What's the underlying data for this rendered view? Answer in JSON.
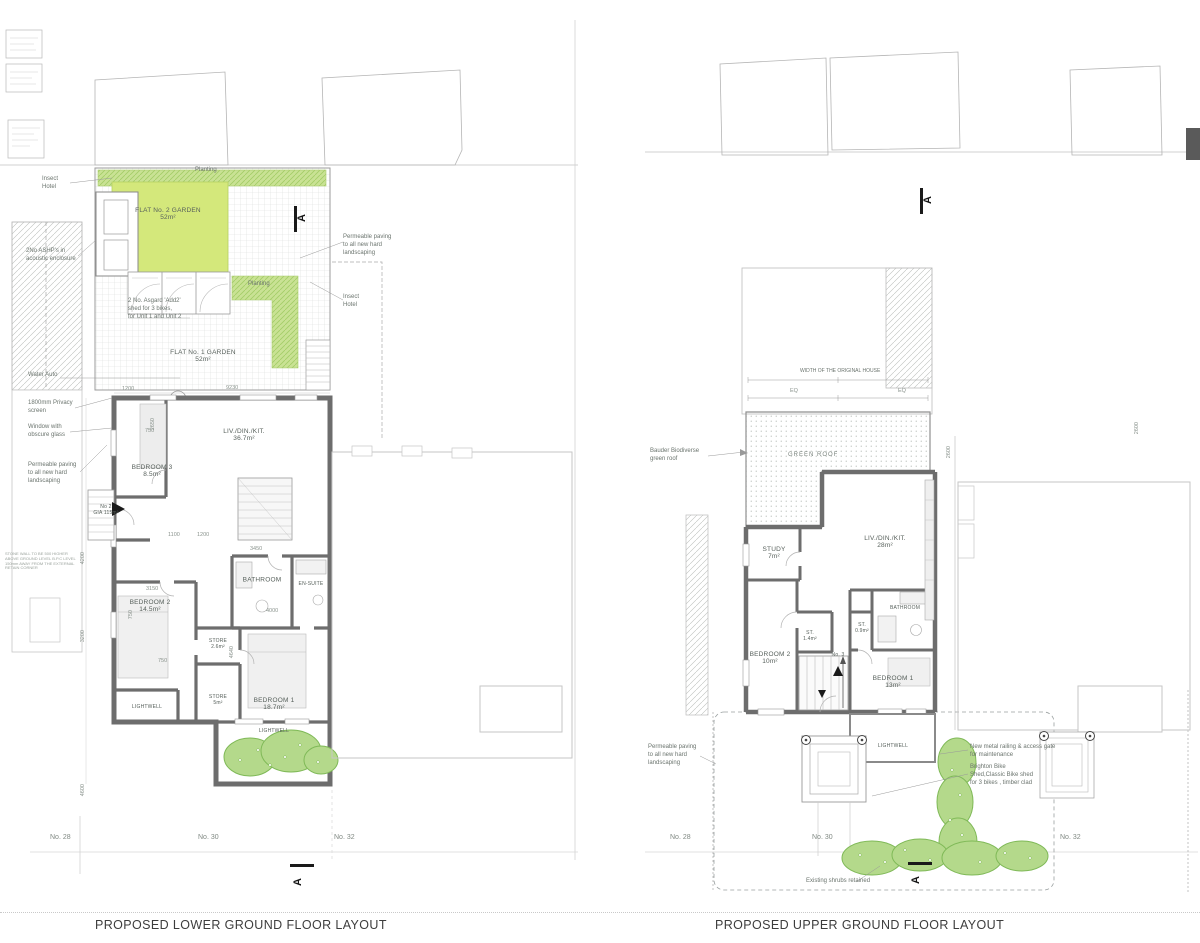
{
  "colors": {
    "wall_dark": "#6d6d6d",
    "garden_green": "#d4e87b",
    "planting_green": "#c3e18e",
    "shrub_green": "#b4d98b",
    "shrub_line": "#7fb957",
    "line_light": "#c4c4c4"
  },
  "left_plan": {
    "title": "PROPOSED LOWER GROUND FLOOR LAYOUT",
    "section_label": "A",
    "garden": {
      "planting_top": "Planting",
      "planting_mid": "Planting",
      "flat2_name": "FLAT No. 2 GARDEN",
      "flat2_area": "52m²",
      "flat1_name": "FLAT No. 1 GARDEN",
      "flat1_area": "52m²",
      "shed_note": "2 No. Asgard 'Add2'\nshed for 3 bikes,\nfor Unit 1 and Unit 2"
    },
    "rooms": {
      "liv": {
        "name": "LIV./DIN./KIT.",
        "area": "36.7m²"
      },
      "bedroom3": {
        "name": "BEDROOM 3",
        "area": "8.5m²"
      },
      "bathroom": {
        "name": "BATHROOM"
      },
      "ensuite": {
        "name": "EN-SUITE"
      },
      "bedroom2": {
        "name": "BEDROOM 2",
        "area": "14.5m²"
      },
      "store_small": {
        "name": "STORE",
        "area": "2.6m²"
      },
      "store_large": {
        "name": "STORE",
        "area": "5m²"
      },
      "bedroom1": {
        "name": "BEDROOM 1",
        "area": "18.7m²"
      },
      "lightwell_left": {
        "name": "LIGHTWELL"
      },
      "lightwell_bottom": {
        "name": "LIGHTWELL"
      },
      "unit": {
        "name": "No 2",
        "area": "GIA 115m²"
      }
    },
    "annotations": {
      "insect_left": "Insect\nHotel",
      "ashp": "2No ASHP's in\nacoustic enclosure",
      "water": "Water Auto",
      "privacy": "1800mm Privacy\nscreen",
      "obscure": "Window with\nobscure glass",
      "permeable": "Permeable paving\nto all new hard\nlandscaping",
      "permeable_right": "Permeable paving\nto all new hard\nlandscaping",
      "insect_right": "Insect\nHotel",
      "stone_note": "STONE WALL TO BE 500 HIGHER\nABOVE GROUND LEVEL B.P.C LEVEL\n150mm AWAY FROM THE EXTERNAL\nRETAIN CORNER"
    },
    "dims": {
      "d0": "1200",
      "d1": "9230",
      "d2": "750",
      "d3": "2650",
      "d4": "1100",
      "d5": "1200",
      "d6": "3450",
      "d7": "3150",
      "d8": "4000",
      "d9": "4640",
      "d10": "4200",
      "d11": "3200",
      "d12": "4600",
      "d13": "750",
      "d14": "750"
    },
    "houses": {
      "n28": "No. 28",
      "n30": "No. 30",
      "n32": "No. 32"
    }
  },
  "right_plan": {
    "title": "PROPOSED UPPER GROUND FLOOR LAYOUT",
    "section_label": "A",
    "labels": {
      "width": "WIDTH OF THE ORIGINAL HOUSE",
      "eq_left": "EQ",
      "eq_right": "EQ",
      "green_roof": "GREEN ROOF",
      "bauder": "Bauder Biodiverse\ngreen roof"
    },
    "rooms": {
      "study": {
        "name": "STUDY",
        "area": "7m²"
      },
      "liv": {
        "name": "LIV./DIN./KIT.",
        "area": "28m²"
      },
      "bathroom": {
        "name": "BATHROOM"
      },
      "st_small": {
        "name": "ST.",
        "area": "0.9m²"
      },
      "st_hall": {
        "name": "ST.",
        "area": "1.4m²"
      },
      "bedroom2": {
        "name": "BEDROOM 2",
        "area": "10m²"
      },
      "bedroom1": {
        "name": "BEDROOM 1",
        "area": "13m²"
      },
      "lightwell": {
        "name": "LIGHTWELL"
      },
      "unit": {
        "name": "No. 3"
      }
    },
    "annotations": {
      "permeable": "Permeable paving\nto all new hard\nlandscaping",
      "railing": "New metal railing & access gate\nfor maintenance",
      "bike_shed": "Brighton Bike\nShed,Classic Bike shed\nfor 3 bikes , timber clad",
      "shrubs": "Existing shrubs retained"
    },
    "dims": {
      "d0": "2600",
      "d1": "2600"
    },
    "houses": {
      "n28": "No. 28",
      "n30": "No. 30",
      "n32": "No. 32"
    }
  }
}
